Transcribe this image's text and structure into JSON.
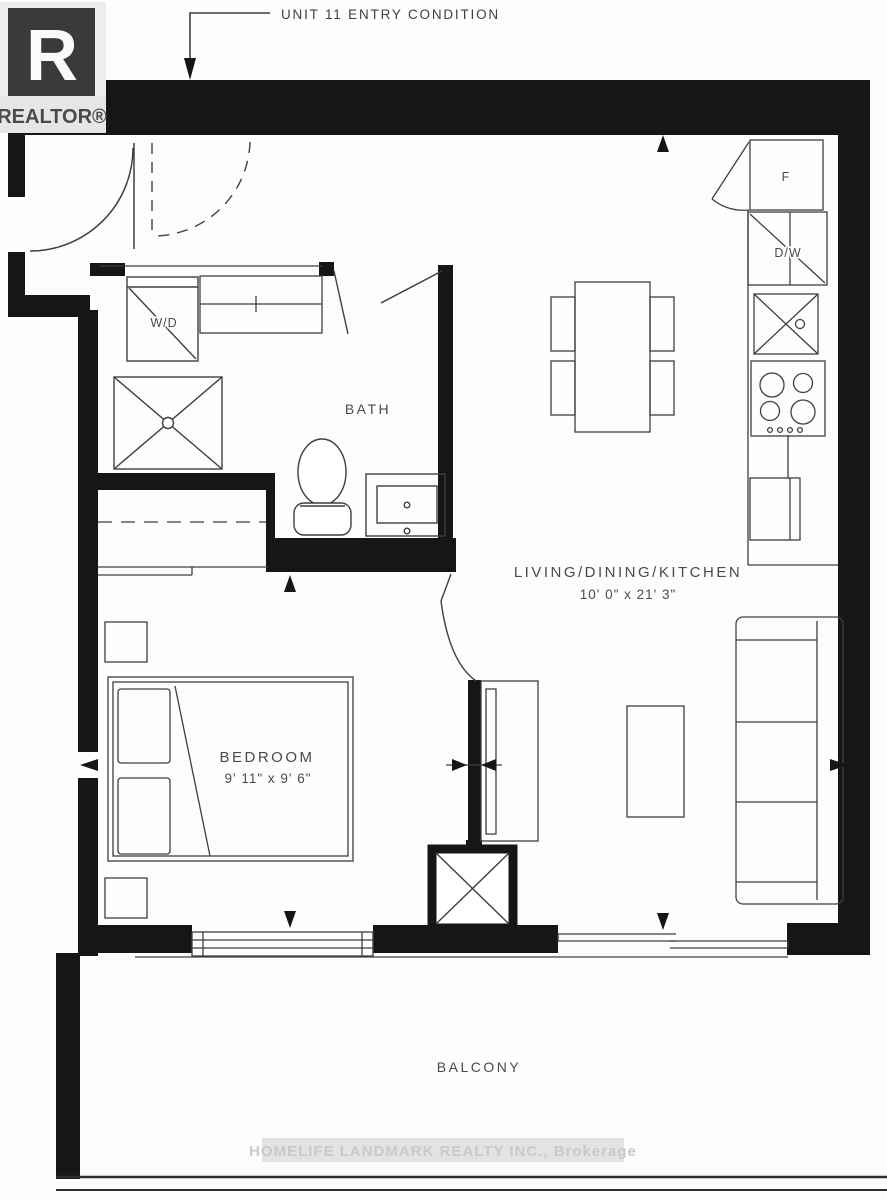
{
  "header": {
    "annotation": "UNIT 11 ENTRY CONDITION"
  },
  "branding": {
    "logo_letter": "R",
    "realtor_label": "REALTOR®"
  },
  "rooms": {
    "bath": {
      "label": "BATH"
    },
    "bedroom": {
      "label": "BEDROOM",
      "dims": "9' 11\" x 9' 6\""
    },
    "living": {
      "label": "LIVING/DINING/KITCHEN",
      "dims": "10' 0\" x 21' 3\""
    },
    "balcony": {
      "label": "BALCONY"
    }
  },
  "appliances": {
    "washer_dryer": "W/D",
    "fridge": "F",
    "dishwasher": "D/W"
  },
  "watermark": {
    "brokerage": "HOMELIFE LANDMARK REALTY INC., Brokerage"
  },
  "colors": {
    "wall": "#161616",
    "line": "#3f3f3f",
    "text": "#4a4a4a",
    "logo_bg": "#3a3a3a",
    "watermark_bg": "#e3e3e3",
    "watermark_text": "#c9c9c9"
  }
}
